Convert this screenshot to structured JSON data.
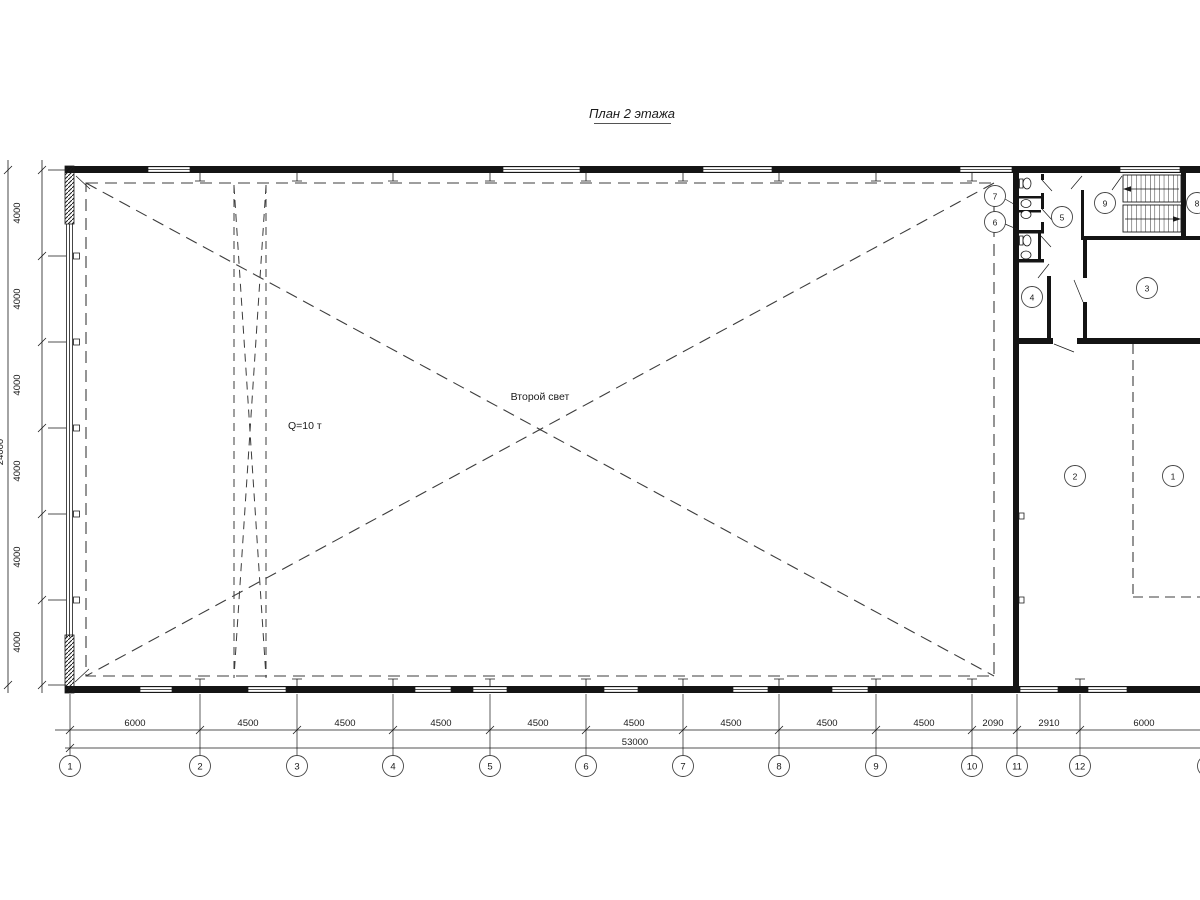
{
  "title": "План 2 этажа",
  "annotations": {
    "second_light": "Второй свет",
    "crane_capacity": "Q=10 т"
  },
  "rooms": [
    "1",
    "2",
    "3",
    "4",
    "5",
    "6",
    "7",
    "8",
    "9"
  ],
  "axes_bottom": [
    "1",
    "2",
    "3",
    "4",
    "5",
    "6",
    "7",
    "8",
    "9",
    "10",
    "11",
    "12"
  ],
  "dims_bottom": [
    "6000",
    "4500",
    "4500",
    "4500",
    "4500",
    "4500",
    "4500",
    "4500",
    "4500",
    "2090",
    "2910",
    "6000"
  ],
  "dim_total_bottom": "53000",
  "dims_left": [
    "4000",
    "4000",
    "4000",
    "4000",
    "4000",
    "4000"
  ],
  "dim_total_left": "24000"
}
